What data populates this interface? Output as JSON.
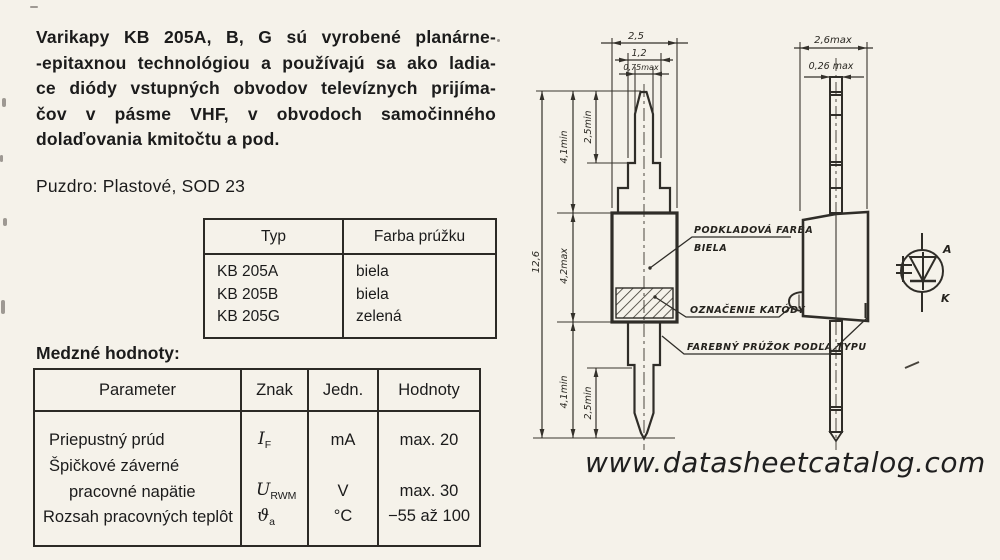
{
  "colors": {
    "paper": "#f5f2ea",
    "ink": "#1b1b1b"
  },
  "intro": {
    "lines": [
      "Varikapy KB 205A, B, G sú vyrobené planárne-",
      "-epitaxnou technológiou a používajú sa ako ladia-",
      "ce diódy vstupných obvodov televíznych prijíma-",
      "čov v pásme VHF, v obvodoch samočinného",
      "dolaďovania kmitočtu a pod."
    ]
  },
  "package_line": "Puzdro: Plastové, SOD 23",
  "type_table": {
    "headers": [
      "Typ",
      "Farba prúžku"
    ],
    "rows": [
      [
        "KB 205A",
        "biela"
      ],
      [
        "KB 205B",
        "biela"
      ],
      [
        "KB 205G",
        "zelená"
      ]
    ]
  },
  "limits_table": {
    "title": "Medzné hodnoty:",
    "headers": [
      "Parameter",
      "Znak",
      "Jedn.",
      "Hodnoty"
    ],
    "rows": [
      {
        "parameter": "Priepustný prúd",
        "symbol_base": "I",
        "symbol_sub": "F",
        "unit": "mA",
        "value": "max. 20"
      },
      {
        "parameter": "Špičkové záverné",
        "parameter_line2": "pracovné napätie",
        "symbol_base": "U",
        "symbol_sub": "RWM",
        "unit": "V",
        "value": "max. 30"
      },
      {
        "parameter": "Rozsah pracovných teplôt",
        "symbol_base": "ϑ",
        "symbol_sub": "a",
        "unit": "°C",
        "value": "−55 až 100"
      }
    ]
  },
  "drawing": {
    "front_view": {
      "dim_body_width": "2,5",
      "dim_lead_width_mid": "1,2",
      "dim_lead_width_tip": "0,75max",
      "dim_total_length": "12,6",
      "dim_lead_top": "4,1min",
      "dim_lead_tip_top": "2,5min",
      "dim_body_length": "4,2max",
      "dim_lead_bottom": "4,1min",
      "dim_lead_tip_bottom": "2,5min",
      "label_base_color_line1": "PODKLADOVÁ FARBA",
      "label_base_color_line2": "BIELA",
      "label_cathode_mark": "OZNAČENIE KATÓDY",
      "label_color_stripe": "FAREBNÝ PRÚŽOK PODĽA TYPU"
    },
    "side_view": {
      "dim_width": "2,6max",
      "dim_lead_thickness": "0,26 max"
    },
    "schematic_symbol": {
      "anode_label": "A",
      "cathode_label": "K"
    }
  },
  "watermark": "www.datasheetcatalog.com"
}
